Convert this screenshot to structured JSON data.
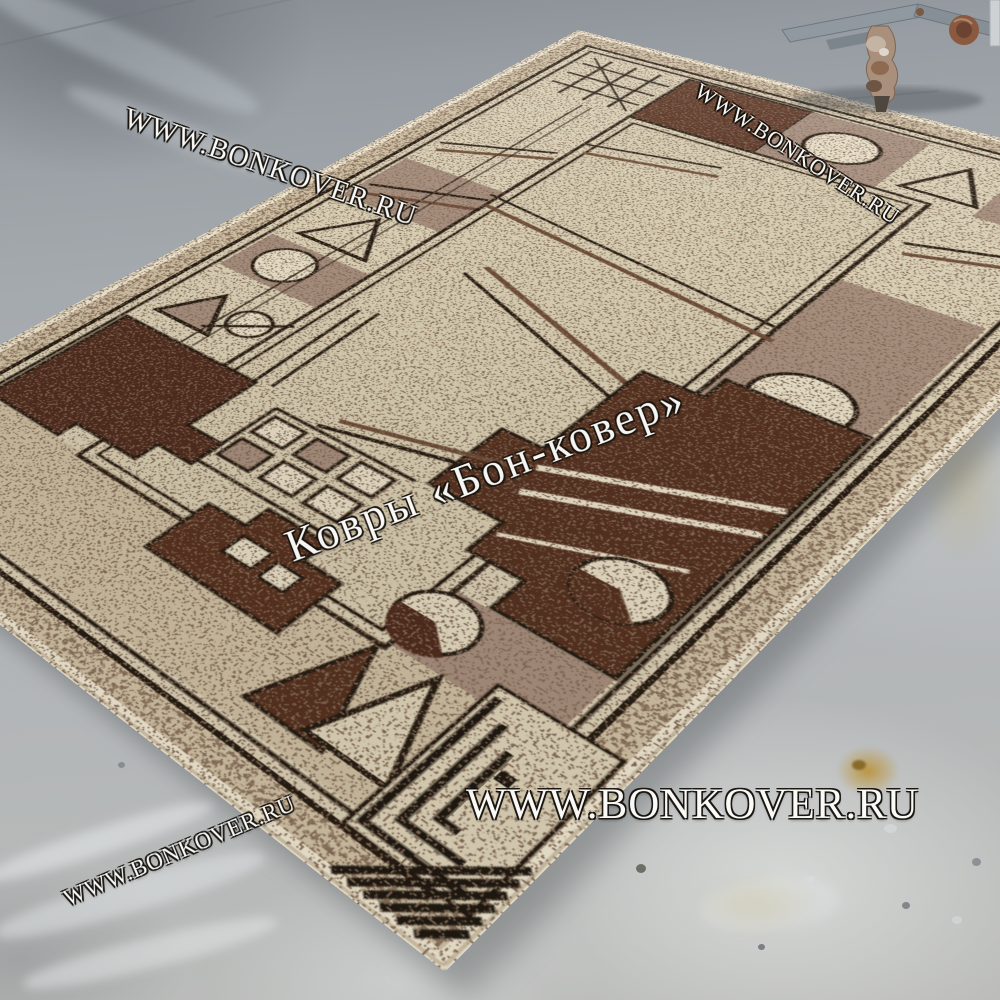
{
  "watermarks": {
    "top_left": {
      "text": "WWW.BONKOVER.RU"
    },
    "top_right": {
      "text": "WWW.BONKOVER.RU"
    },
    "center": {
      "text": "Ковры «Бон-ковер»"
    },
    "bottom_center": {
      "text": "WWW.BONKOVER.RU"
    },
    "bottom_left": {
      "text": "WWW.BONKOVER.RU"
    }
  },
  "scene": {
    "type": "product-photo",
    "subject": "beige and brown geometric bordered rug lying diagonally on a gray painted concrete floor",
    "palette": {
      "floor_gray": "#aab0b4",
      "rug_cream": "#d9cfb5",
      "rug_binding": "#efe7d2",
      "rug_taupe": "#a68e7e",
      "rug_brown": "#54301f",
      "rug_outline_black": "#241b12",
      "stain_yellow": "#c0973f",
      "rust_metal": "#8a5940"
    },
    "rug_motifs": [
      "hatch-corner",
      "brown-blocks",
      "cream-circles",
      "pie-slice-circle",
      "triangle-outlines",
      "windows-grid",
      "greek-key-maze",
      "corner-chevrons",
      "thin-stick-lines"
    ]
  }
}
